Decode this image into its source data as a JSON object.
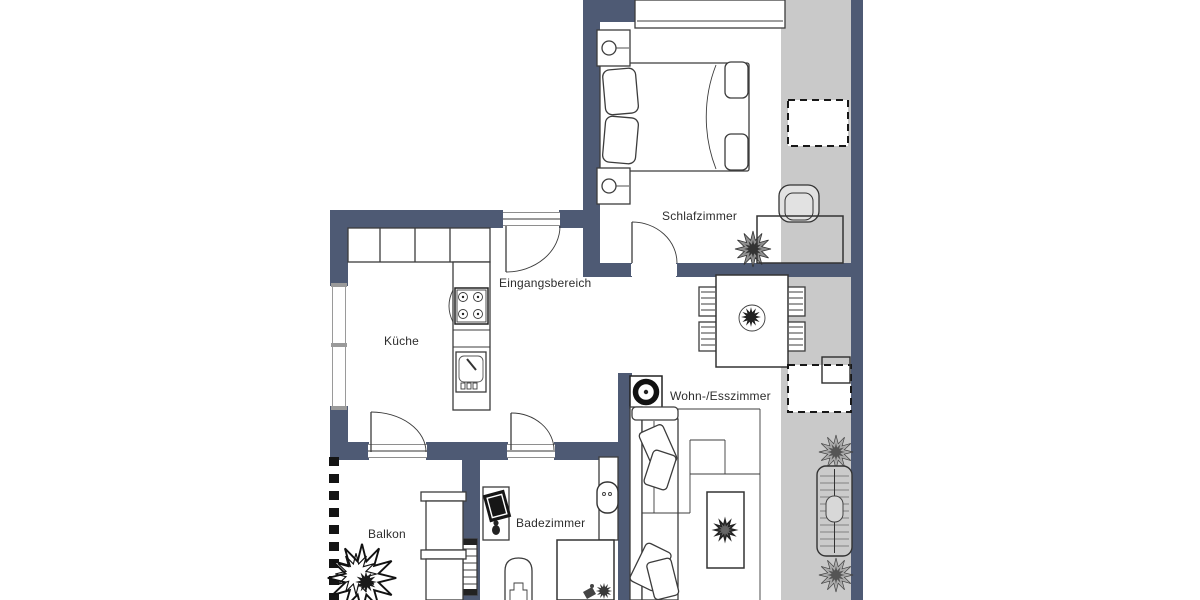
{
  "rooms": {
    "schlafzimmer": {
      "label": "Schlafzimmer"
    },
    "eingangsbereich": {
      "label": "Eingangsbereich"
    },
    "kueche": {
      "label": "Küche"
    },
    "wohn_esszimmer": {
      "label": "Wohn-/Esszimmer"
    },
    "badezimmer": {
      "label": "Badezimmer"
    },
    "balkon": {
      "label": "Balkon"
    }
  },
  "colors": {
    "wall": "#4e5a74",
    "outdoor_area": "#c9c9c9",
    "floor": "#ffffff",
    "outline": "#3c3c3c",
    "railing": "#141414",
    "label_text": "#2d2d2d"
  },
  "furniture_icons": {
    "schlafzimmer": [
      "wardrobe",
      "double-bed",
      "nightstand-with-lamp",
      "nightstand-with-lamp",
      "plant",
      "desk",
      "desk-chair",
      "door-swing"
    ],
    "eingangsbereich": [
      "entrance-door-swing"
    ],
    "kueche": [
      "kitchen-counter",
      "stove-four-burners",
      "kitchen-sink",
      "door-swing"
    ],
    "wohn_esszimmer": [
      "dining-table",
      "dining-chair",
      "dining-chair",
      "dining-chair",
      "dining-chair",
      "plant-centerpiece",
      "washing-machine",
      "sofa",
      "cushions",
      "coffee-table",
      "plant"
    ],
    "badezimmer": [
      "washer-on-stand",
      "washbasin",
      "toilet",
      "shower",
      "radiator",
      "door-swing"
    ],
    "balkon": [
      "railing-dashed",
      "large-plant",
      "shelf-unit"
    ],
    "outdoor_strip": [
      "roof-window-dashed",
      "roof-window-dashed",
      "plant",
      "sun-lounger",
      "plant"
    ]
  }
}
